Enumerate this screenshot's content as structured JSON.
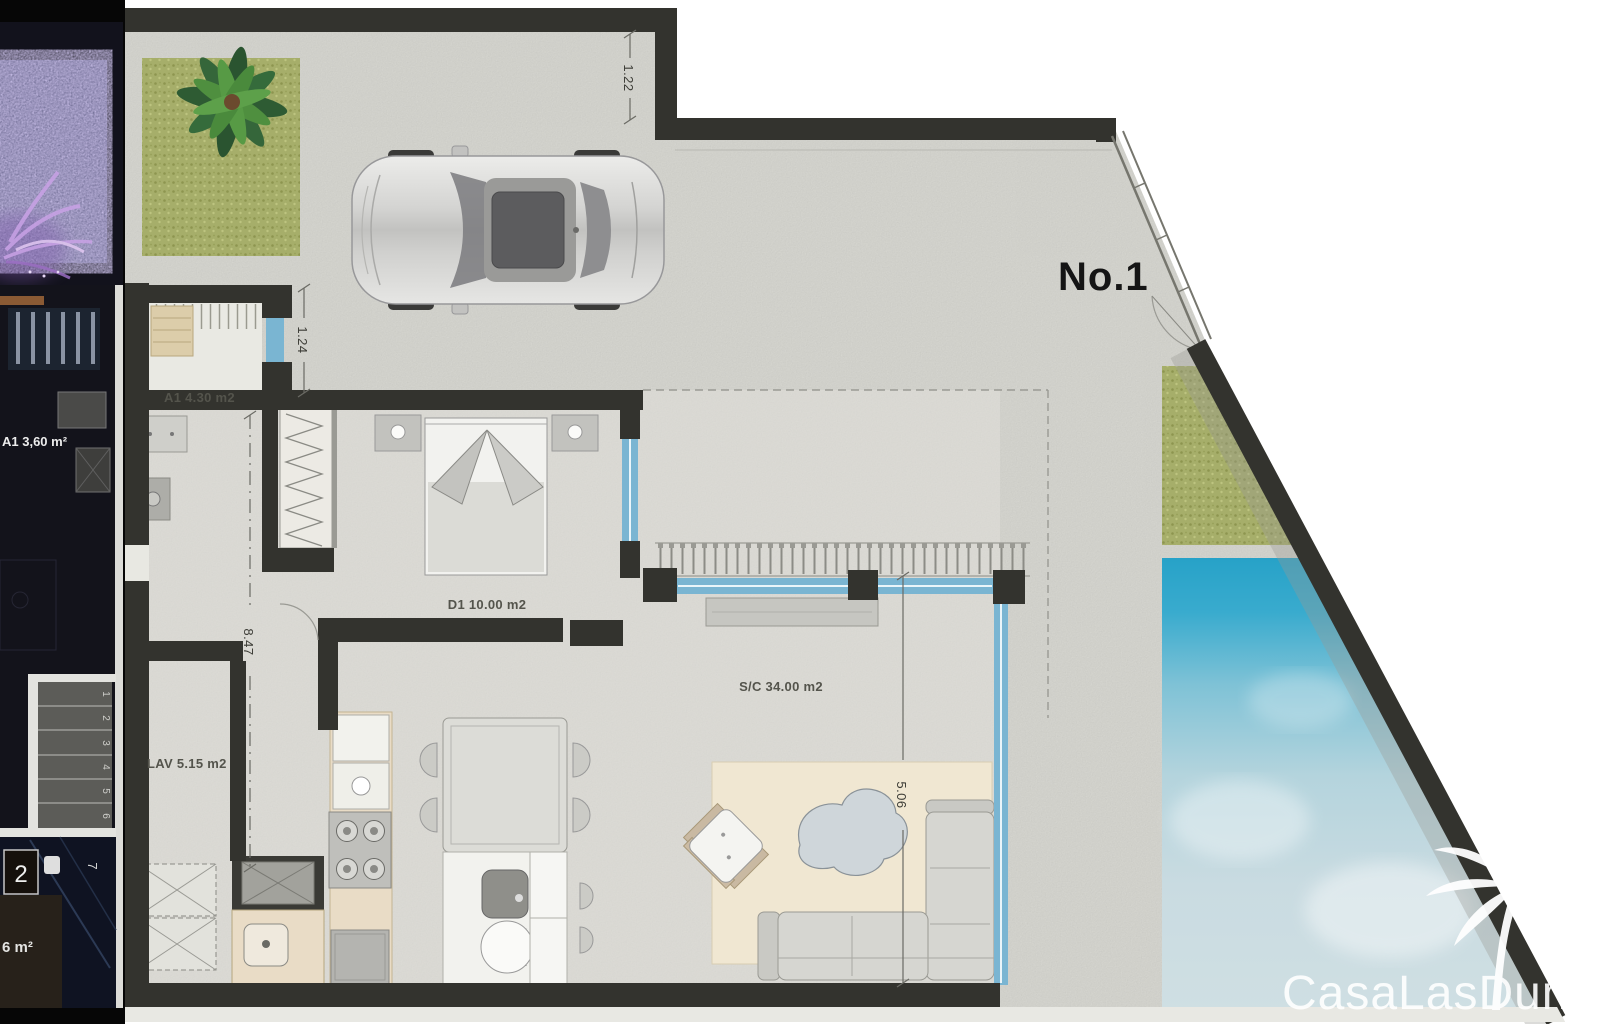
{
  "unit": {
    "label": "No.1"
  },
  "watermark": {
    "text": "CasaLasDunas"
  },
  "rooms": {
    "storage": {
      "label": "A1 4.30 m2"
    },
    "bedroom": {
      "label": "D1 10.00 m2"
    },
    "laundry": {
      "label": "LAV 5.15 m2"
    },
    "living": {
      "label": "S/C 34.00 m2"
    }
  },
  "dimensions": {
    "setback_top": "1.22",
    "entry": "1.24",
    "plot_depth": "8.47",
    "terrace_depth": "5.06"
  },
  "side_plan": {
    "room_label": "A1 3,60 m²",
    "area_partial": "6 m²",
    "stairs": [
      "1",
      "2",
      "3",
      "4",
      "5",
      "6"
    ],
    "landing": "2",
    "step": "7"
  },
  "colors": {
    "wall": "#33332e",
    "concrete": "#dcdcd6",
    "pool": "#27a2c8",
    "pool-light": "#cfdfe3",
    "grass": "#a6ae6a",
    "glazing": "#7ab5d2",
    "rug": "#f0e7d2",
    "counter": "#e9dcc6",
    "watermark": "#ffffff"
  }
}
